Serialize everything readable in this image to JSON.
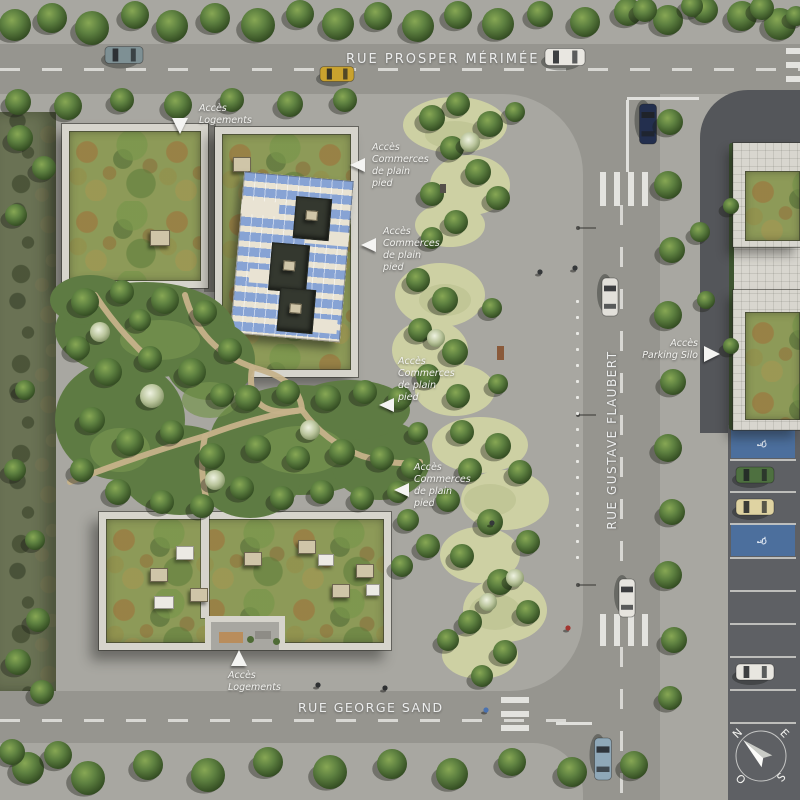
{
  "streets": {
    "top": "RUE PROSPER MÉRIMÉE",
    "right": "RUE GUSTAVE FLAUBERT",
    "bottom": "RUE GEORGE SAND"
  },
  "annotations": {
    "logements_top": {
      "line1": "Accès",
      "line2": "Logements"
    },
    "commerces_1": {
      "line1": "Accès",
      "line2": "Commerces",
      "line3": "de plain",
      "line4": "pied"
    },
    "commerces_2": {
      "line1": "Accès",
      "line2": "Commerces",
      "line3": "de plain",
      "line4": "pied"
    },
    "commerces_3": {
      "line1": "Accès",
      "line2": "Commerces",
      "line3": "de plain",
      "line4": "pied"
    },
    "commerces_4": {
      "line1": "Accès",
      "line2": "Commerces",
      "line3": "de plain",
      "line4": "pied"
    },
    "parking_silo": {
      "line1": "Accès",
      "line2": "Parking Silo"
    },
    "logements_bottom": {
      "line1": "Accès",
      "line2": "Logements"
    }
  },
  "compass": {
    "north": "N",
    "east": "E",
    "south": "S",
    "west": "O"
  },
  "icons": {
    "wheelchair": "♿"
  },
  "colors": {
    "street_asphalt": "#96958f",
    "plaza_paving": "#a8a7a1",
    "dark_asphalt": "#54565a",
    "parking_asphalt": "#5e6064",
    "solar_panel_blue": "#87a3d4",
    "sedum_roof_green": "#8d9a58",
    "tree_green": "#44622f",
    "handicap_bay_blue": "#4c6f9d",
    "road_marking_white": "#e8e8e4",
    "label_text_white": "#f2f2ef"
  }
}
